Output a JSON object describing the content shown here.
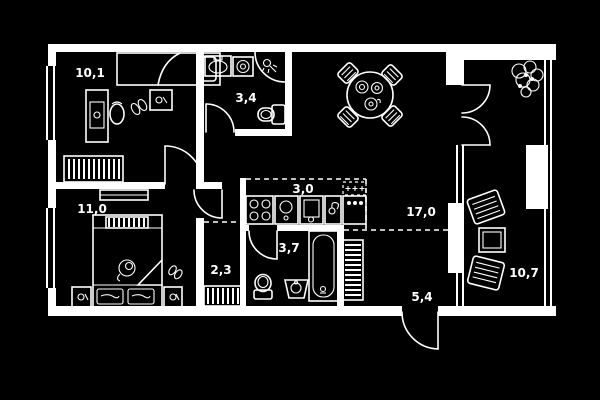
{
  "plan": {
    "type": "apartment-floor-plan",
    "colors": {
      "background": "#000000",
      "lines": "#ffffff",
      "labels": "#ffffff"
    },
    "rooms": {
      "bedroom1": {
        "name": "bedroom-1",
        "area": "10,1"
      },
      "bathroom1": {
        "name": "bathroom-1",
        "area": "3,4"
      },
      "bedroom2": {
        "name": "bedroom-2",
        "area": "11,0"
      },
      "hall": {
        "name": "inner-hall",
        "area": "2,3"
      },
      "bathroom2": {
        "name": "bathroom-2",
        "area": "3,7"
      },
      "kitchen": {
        "name": "kitchen-zone",
        "area": "3,0"
      },
      "living": {
        "name": "living-room",
        "area": "17,0"
      },
      "entrance": {
        "name": "entrance-hall",
        "area": "5,4"
      },
      "balcony": {
        "name": "balcony",
        "area": "10,7"
      }
    }
  }
}
